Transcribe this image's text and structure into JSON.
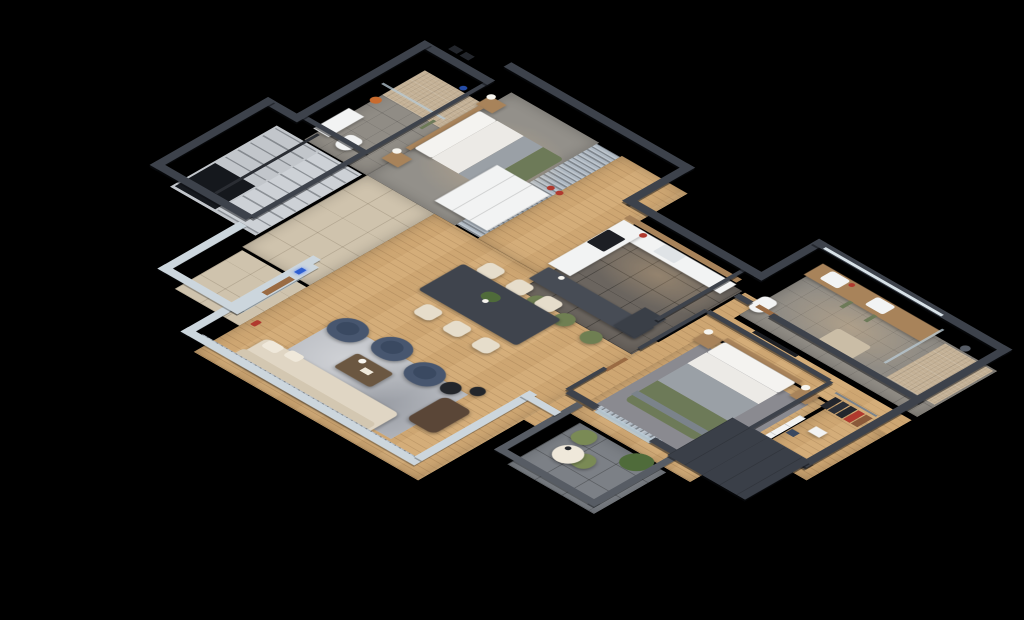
{
  "scene": {
    "type": "isometric-3d-floor-plan",
    "view": "cutaway top-down isometric render",
    "background": "#000000"
  },
  "rooms": [
    {
      "id": "bathroom-1",
      "floor": "gray-tile-with-mosaic-shower"
    },
    {
      "id": "bedroom-1",
      "floor": "gray-carpet"
    },
    {
      "id": "wardrobe-1",
      "floor": "curtained-closet"
    },
    {
      "id": "hallway-1",
      "floor": "wood"
    },
    {
      "id": "staircase",
      "floor": "concrete-steps"
    },
    {
      "id": "entry-hall",
      "floor": "beige-tile"
    },
    {
      "id": "elevator",
      "floor": "beige-tile"
    },
    {
      "id": "kitchen",
      "floor": "dark-gray-tile"
    },
    {
      "id": "dining-area",
      "floor": "wood"
    },
    {
      "id": "living-room",
      "floor": "wood-with-gray-rug"
    },
    {
      "id": "corridor",
      "floor": "wood"
    },
    {
      "id": "bathroom-2",
      "floor": "gray-tile-with-mosaic-shower"
    },
    {
      "id": "bedroom-2",
      "floor": "wood-with-gray-rug"
    },
    {
      "id": "walk-in-closet",
      "floor": "wood"
    },
    {
      "id": "terrace",
      "floor": "stone-tile"
    }
  ],
  "furniture": [
    "double-bed-green-gray-bedding-x2",
    "nightstands-with-lamps",
    "shower-glass-enclosure-x2",
    "toilet-x2",
    "vanity-sink",
    "double-vanity-two-sinks",
    "u-shaped-staircase-with-railing",
    "elevator-cab-glass-door",
    "white-storage-unit",
    "l-shaped-kitchen-counter",
    "cooktop",
    "kitchen-island-bar",
    "green-bar-stools-x3",
    "fridge",
    "dining-table-dark",
    "cream-dining-chairs-x6",
    "navy-armchairs-x3",
    "gray-area-rug",
    "coffee-table",
    "cream-sectional-sofa",
    "brown-leather-lounge-chair",
    "black-side-tables-x2",
    "window-curtains",
    "tv-panel",
    "green-accent-chair",
    "clothes-racks-with-red-garment",
    "terrace-green-chairs-x2",
    "round-terrace-table",
    "potted-plant"
  ],
  "colors": {
    "background": "#000000",
    "wall_dark": "#3d424b",
    "wall_light": "#ccd6dd",
    "parapet": "#575c64",
    "dark_mass": "#3a3f48",
    "wood_floor": "#d4ad79",
    "tile_entry": "#cfc3ad",
    "kitchen_tile": "#6b655f",
    "bath_tile": "#908c85",
    "shower_mosaic": "#c4b196",
    "concrete": "#c2c6cb",
    "step_light": "#cdd1d6",
    "stair_void": "#15181d",
    "bedroom1_floor": "#93908a",
    "rug_living": "#b7bac0",
    "rug_bedroom": "#8a8a90",
    "rug_bath": "#cabda6",
    "sofa_cream": "#e0d6c4",
    "sofa_back": "#d3c7b1",
    "chair_cream": "#e6ddcb",
    "pillow_cream": "#efe8da",
    "navy": "#47566f",
    "navy_dark": "#3a4961",
    "green_textile": "#6d7a58",
    "stool_green": "#6f7f52",
    "chair_green2": "#7a8a55",
    "island_dark": "#474c55",
    "table_dark": "#3f444d",
    "coffee_table": "#6b5741",
    "brown_leather": "#5a4637",
    "wood_furniture": "#a8835a",
    "white_furniture": "#f2f3f3",
    "white_soft": "#dfe3e6",
    "bed_white": "#f4f3f0",
    "bed_duvet": "#eceae6",
    "bed_gray": "#9aa0a6",
    "bed_throw": "#7b838b",
    "appliance_black": "#1d1f24",
    "fridge_dark": "#3a3f47",
    "curtain": "#aeb8c2",
    "glass": "#b9cbd6",
    "terrace_stone": "#7c8086",
    "plant_green": "#4f6b3a",
    "accent_red": "#b0392e",
    "accent_orange": "#c96b2e",
    "accent_blue": "#2e5fd0",
    "lamp_white": "#f7f5ef",
    "door_wood": "#9a6b43",
    "black_table": "#23262b",
    "railing": "#2a2d33",
    "shower_head": "#565c66",
    "clothes_dark": "#23262c",
    "clothes_dark2": "#2b2f37",
    "clothes_brown": "#8a5a3a",
    "mirror": "#d8e2e8"
  }
}
